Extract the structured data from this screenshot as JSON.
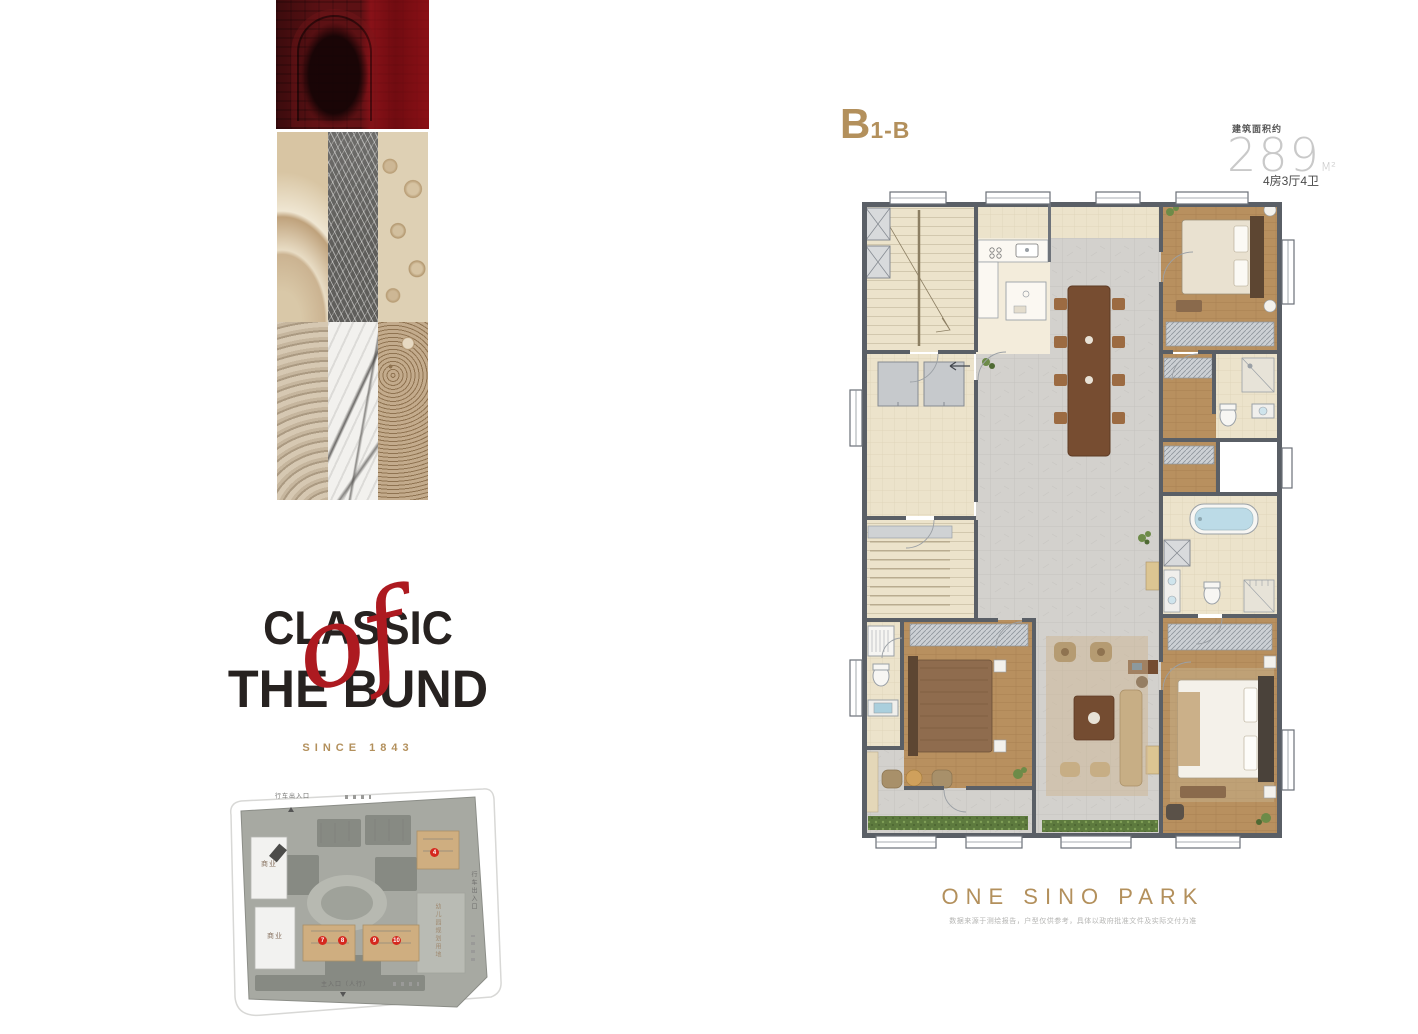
{
  "plan": {
    "title_main": "B",
    "title_sub": "1-B",
    "area_label": "建筑面积约",
    "area_value": "289",
    "area_unit": "M²",
    "layout": "4房3厅4卫"
  },
  "logo": {
    "line1": "CLASSIC",
    "of": "of",
    "line2": "THE BUND",
    "since": "SINCE 1843"
  },
  "footer": {
    "brand_name": "ONE SINO PARK",
    "disclaimer": "数据来源于测绘报告，户型仅供参考，具体以政府批准文件及实际交付为准"
  },
  "sitemap": {
    "labels": {
      "vehicle_entrance_top": "行车出入口",
      "vehicle_entrance_right": "行车出入口",
      "commercial_1": "商业",
      "commercial_2": "商业",
      "kindergarten": "幼儿园规划用地",
      "main_entrance": "主入口（人行）"
    },
    "markers": [
      "4",
      "7",
      "8",
      "9",
      "10"
    ]
  },
  "colors": {
    "gold": "#b3905c",
    "logo_red": "#ad1a20",
    "marker_red": "#d5281e",
    "wall_gray": "#5a5f66"
  }
}
